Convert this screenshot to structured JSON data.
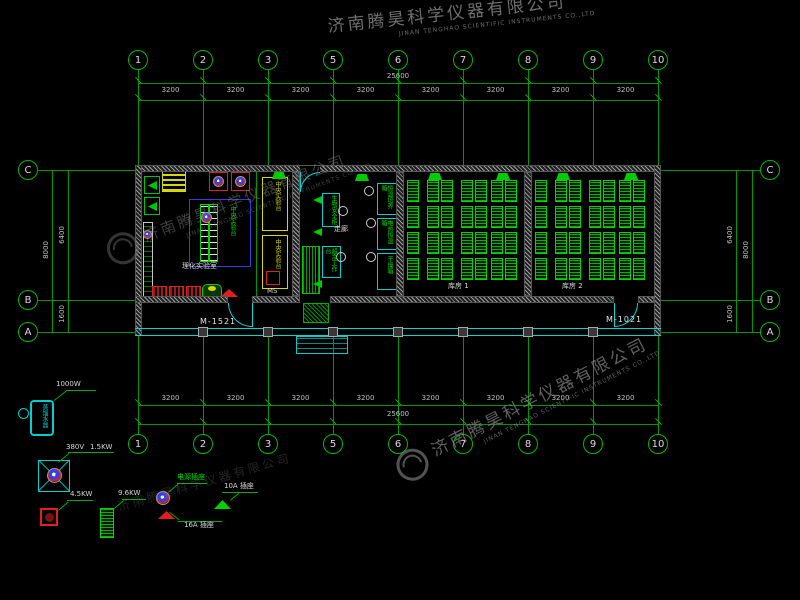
{
  "watermark": {
    "company_cn": "济南腾昊科学仪器有限公司",
    "company_en": "JINAN TENGHAO SCIENTIFIC INSTRUMENTS CO.,LTD"
  },
  "grid": {
    "columns": [
      "1",
      "2",
      "3",
      "5",
      "6",
      "7",
      "8",
      "9",
      "10"
    ],
    "rows": [
      "C",
      "B",
      "A"
    ],
    "bay_width": "3200",
    "total_width": "25600",
    "dim_c_to_b": "6400",
    "dim_b_to_a": "1600",
    "dim_total_height": "8000"
  },
  "labels": {
    "room_left": "理化实验室",
    "corridor": "走廊",
    "storage1": "库房 1",
    "storage2": "库房 2",
    "door_left": "M-1521",
    "door_right": "M-1021",
    "central_bench": "中央实验台",
    "side_bench": "中央实验台",
    "inst_a1": "生物安全柜",
    "inst_a2": "超净工作台",
    "inst_b1": "恒温培养箱",
    "inst_b2": "电热恒温箱",
    "inst_b3": "干燥箱",
    "ms_tag": "MS"
  },
  "legend": {
    "distiller_power": "1000W",
    "distiller_device": "蒸馏水器",
    "mixer_voltage": "380V",
    "mixer_power": "1.5KW",
    "heater_power": "4.5KW",
    "rack_power": "9.6KW",
    "socket_power": "电源插座",
    "socket_16a": "16A 插座",
    "socket_10a": "10A 插座"
  },
  "colors": {
    "grid_green": "#009800",
    "wall_cyan": "#00d8d8",
    "equipment_green": "#00cc00",
    "alert_red": "#e02020",
    "bench_yellow": "#d8d800",
    "zone_blue": "#3a3ad8"
  }
}
